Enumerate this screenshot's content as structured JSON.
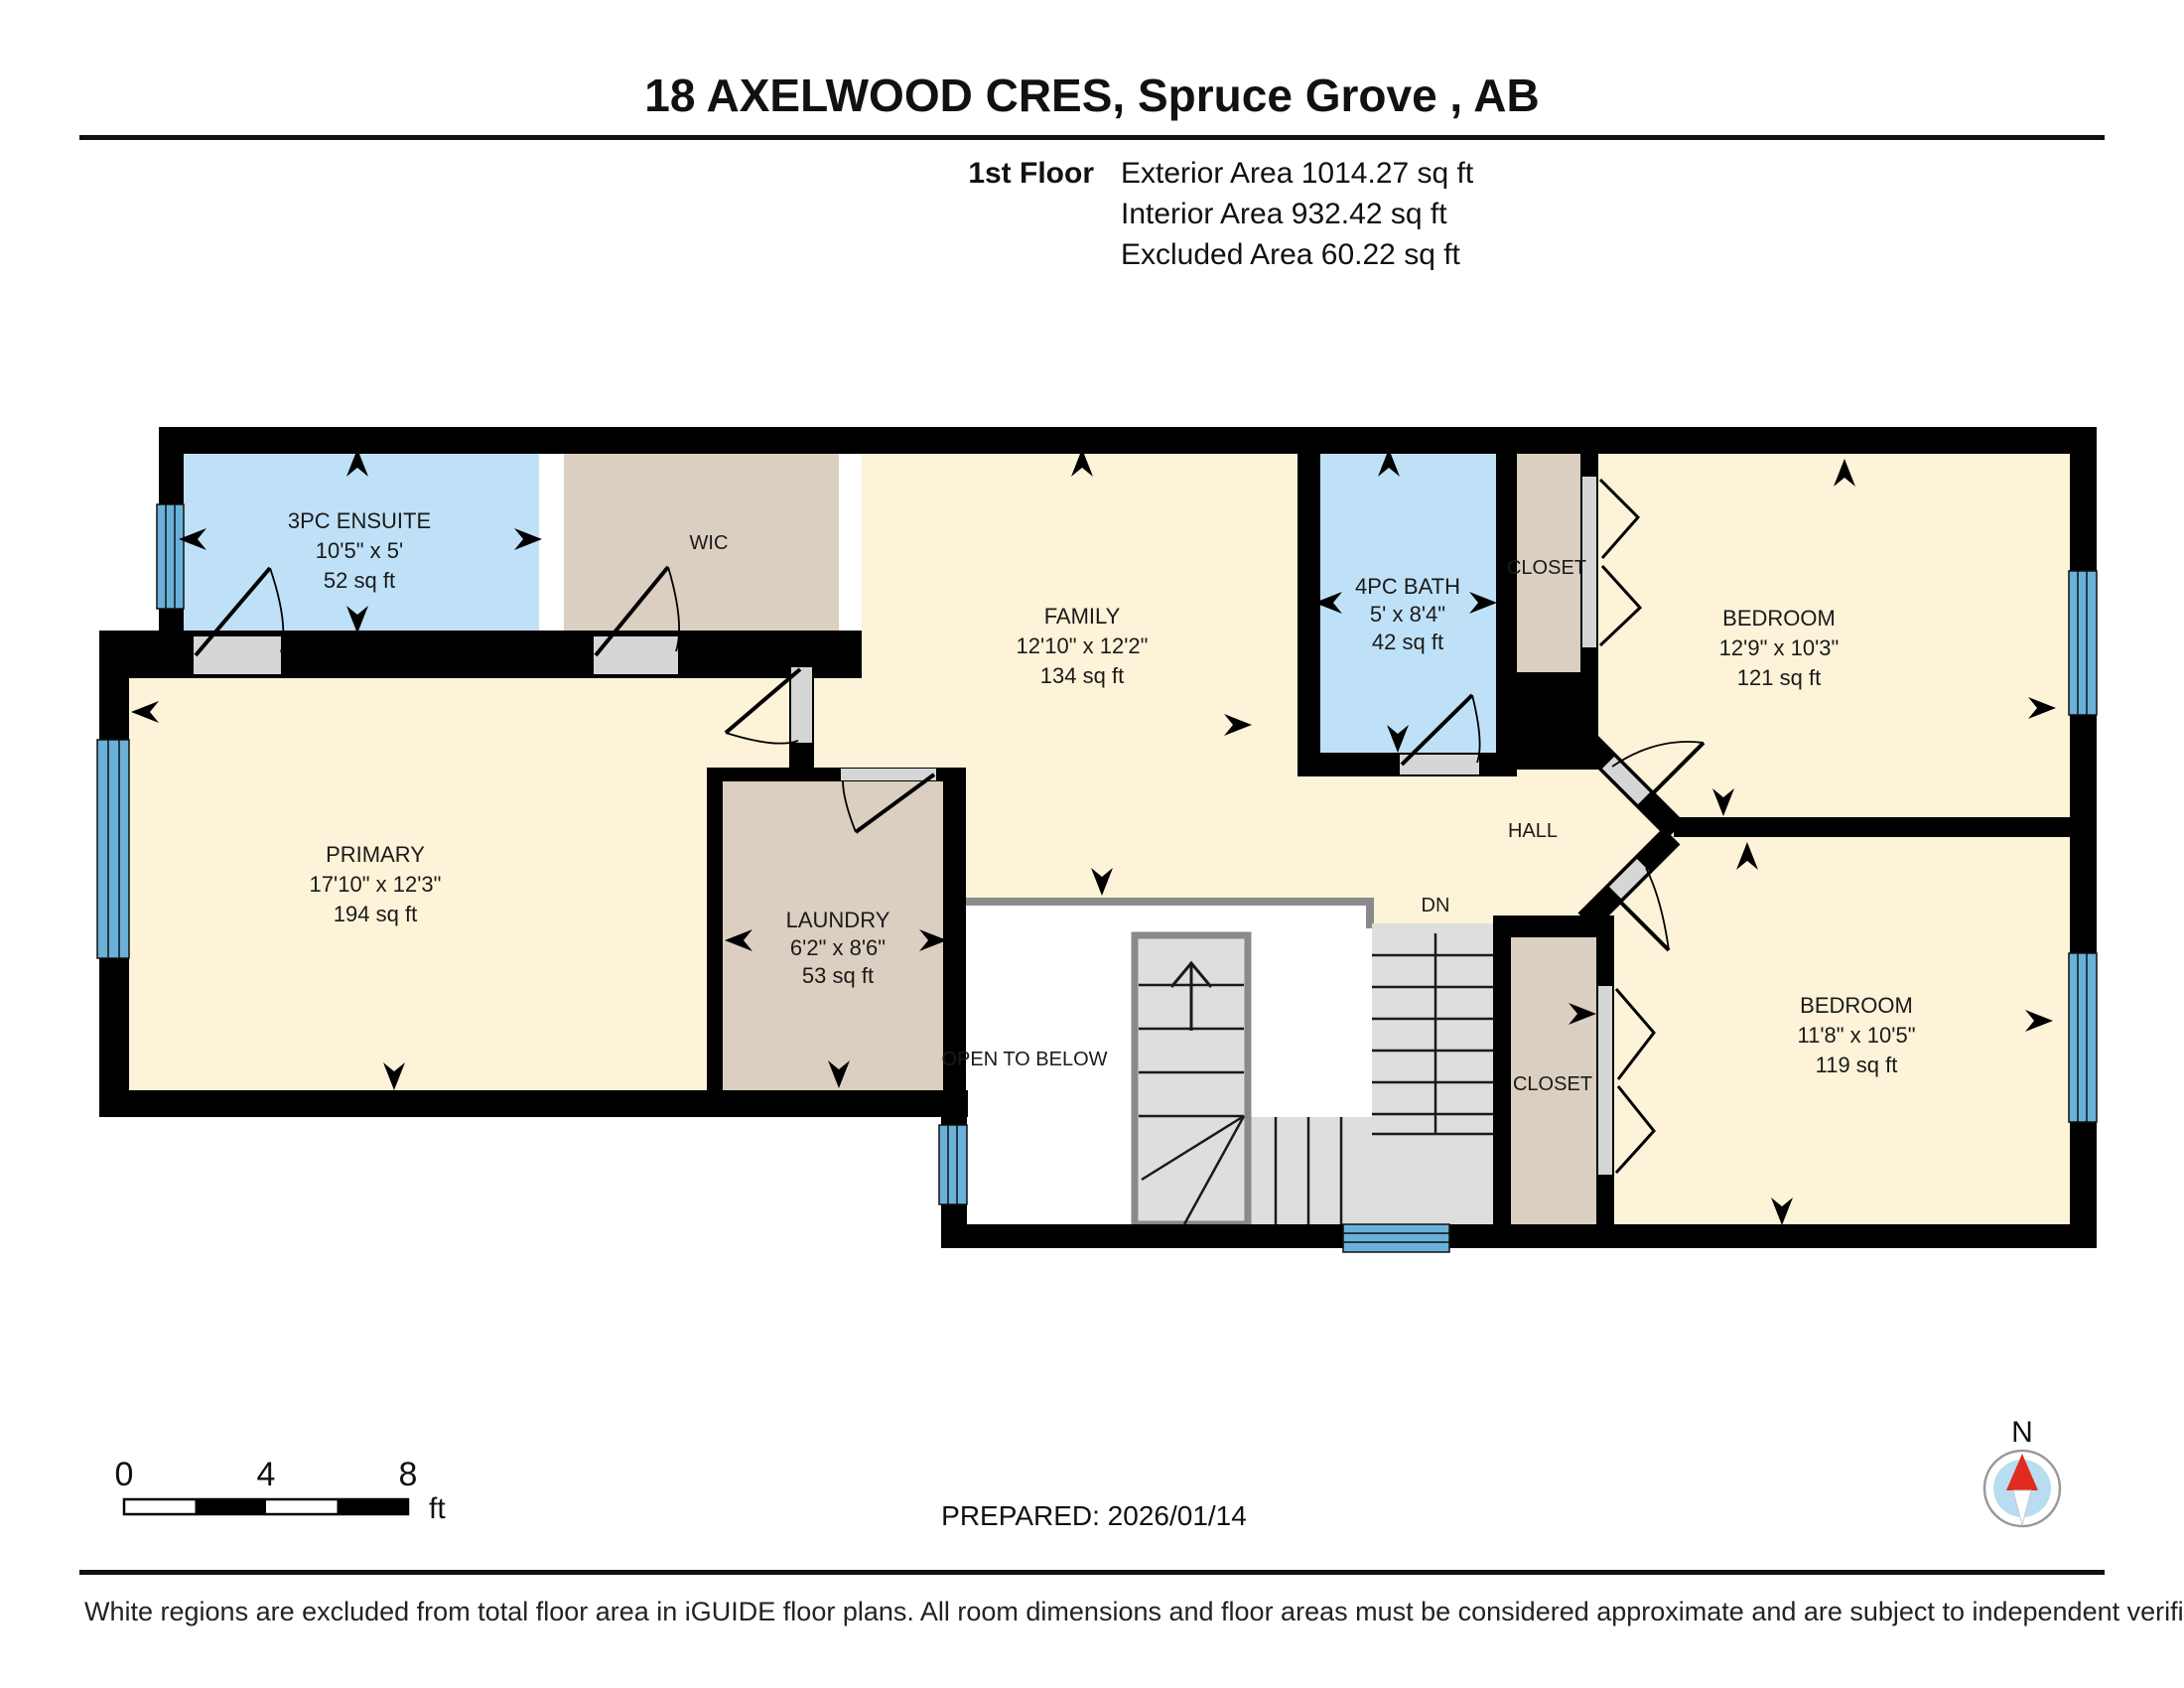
{
  "header": {
    "title": "18 AXELWOOD CRES, Spruce Grove , AB",
    "floor_label": "1st Floor",
    "areas": {
      "exterior": "Exterior Area 1014.27 sq ft",
      "interior": "Interior Area 932.42 sq ft",
      "excluded": "Excluded Area 60.22 sq ft"
    }
  },
  "rooms": {
    "ensuite": {
      "name": "3PC ENSUITE",
      "dims": "10'5\" x 5'",
      "area": "52 sq ft"
    },
    "wic": {
      "name": "WIC"
    },
    "family": {
      "name": "FAMILY",
      "dims": "12'10\" x 12'2\"",
      "area": "134 sq ft"
    },
    "bath": {
      "name": "4PC BATH",
      "dims": "5' x 8'4\"",
      "area": "42 sq ft"
    },
    "closet_top": {
      "name": "CLOSET"
    },
    "bedroom1": {
      "name": "BEDROOM",
      "dims": "12'9\" x 10'3\"",
      "area": "121 sq ft"
    },
    "primary": {
      "name": "PRIMARY",
      "dims": "17'10\" x 12'3\"",
      "area": "194 sq ft"
    },
    "laundry": {
      "name": "LAUNDRY",
      "dims": "6'2\" x 8'6\"",
      "area": "53 sq ft"
    },
    "open_below": {
      "name": "OPEN TO BELOW"
    },
    "hall": {
      "name": "HALL"
    },
    "closet_bottom": {
      "name": "CLOSET"
    },
    "bedroom2": {
      "name": "BEDROOM",
      "dims": "11'8\" x 10'5\"",
      "area": "119 sq ft"
    }
  },
  "stairs": {
    "down_label": "DN"
  },
  "footer": {
    "scale": {
      "t0": "0",
      "t4": "4",
      "t8": "8",
      "unit": "ft"
    },
    "prepared": "PREPARED: 2026/01/14",
    "compass_north": "N",
    "disclaimer": "White regions are excluded from total floor area in iGUIDE floor plans. All room dimensions and floor areas must be considered approximate and are subject to independent verification."
  },
  "colors": {
    "wall": "#000000",
    "room_cream": "#fdf3d8",
    "room_blue": "#bfe1f8",
    "room_tan": "#dacfc0",
    "stair_gray": "#dedede",
    "threshold_gray": "#d6d6d6",
    "window_blue": "#6ab1da",
    "open_boundary_gray": "#8a8a8a",
    "compass_red": "#e02b20",
    "compass_inner_blue": "#b8ddf0"
  }
}
